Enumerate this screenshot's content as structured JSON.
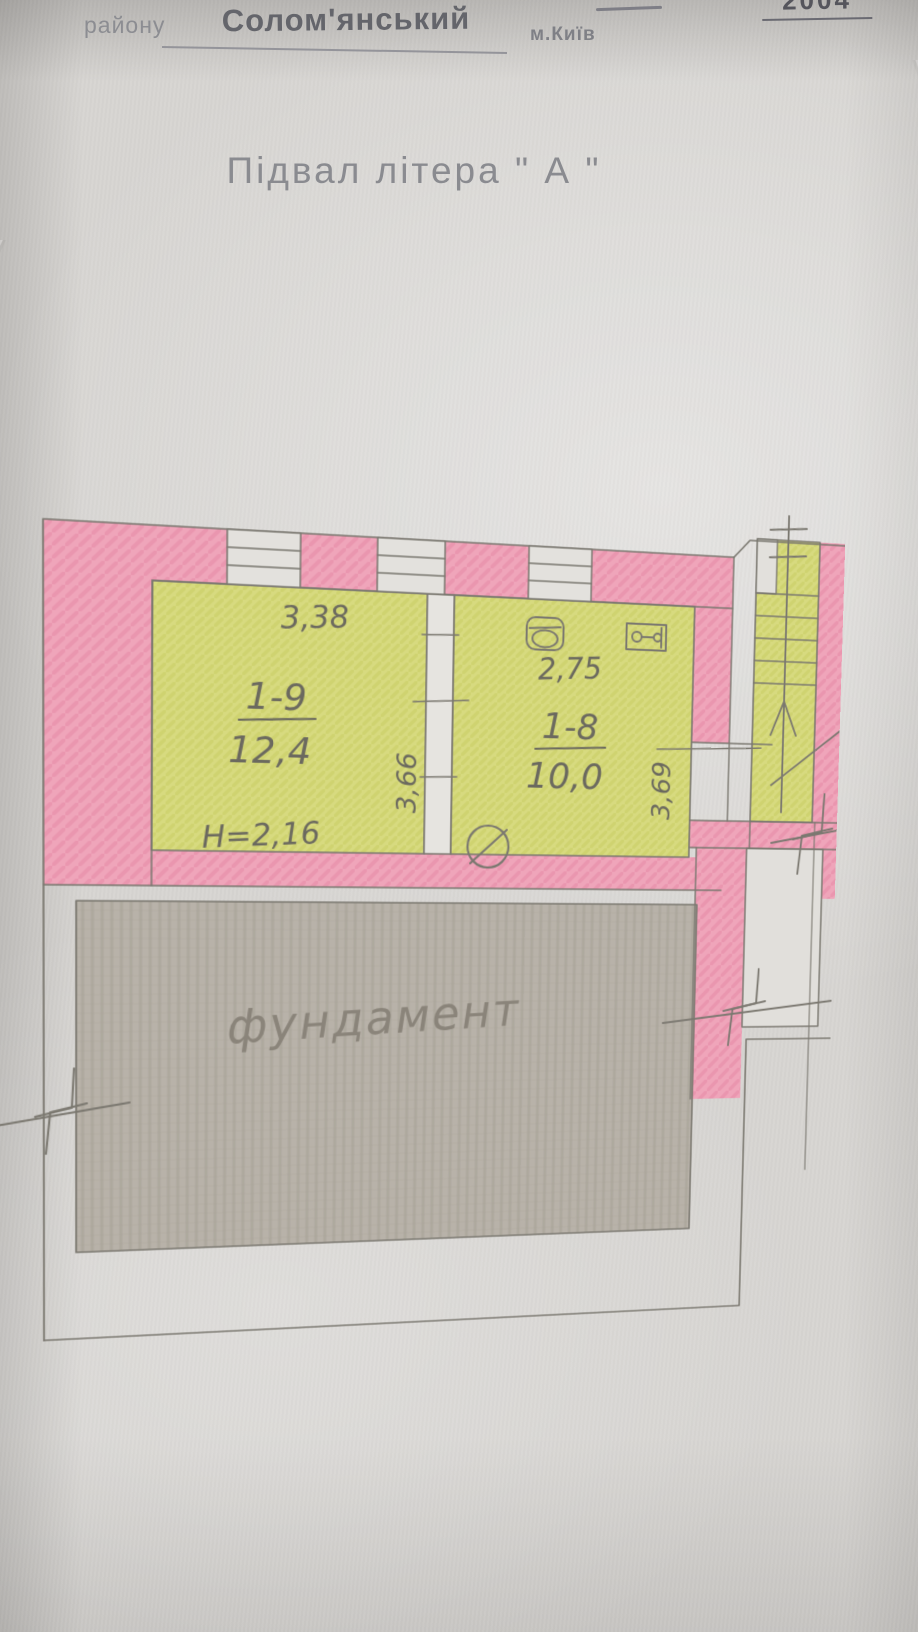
{
  "header": {
    "year_fragment": "2004",
    "district_label": "району",
    "district_value": "Солом'янський",
    "city_label": "м.Київ"
  },
  "title": "Підвал   літера \" А \"",
  "plan": {
    "rooms": [
      {
        "id": "1-9",
        "area": "12,4",
        "width_dim": "3,38",
        "depth_dim": "3,66",
        "height_note": "H=2,16"
      },
      {
        "id": "1-8",
        "area": "10,0",
        "width_dim": "2,75",
        "depth_dim": "3,69"
      }
    ],
    "foundation_label": "фундамент",
    "colors": {
      "wall_pink": "#efa5ba",
      "room_yellow": "#d7da7f",
      "foundation_gray": "#b8b2a9",
      "pencil_line": "#7b7870"
    }
  }
}
